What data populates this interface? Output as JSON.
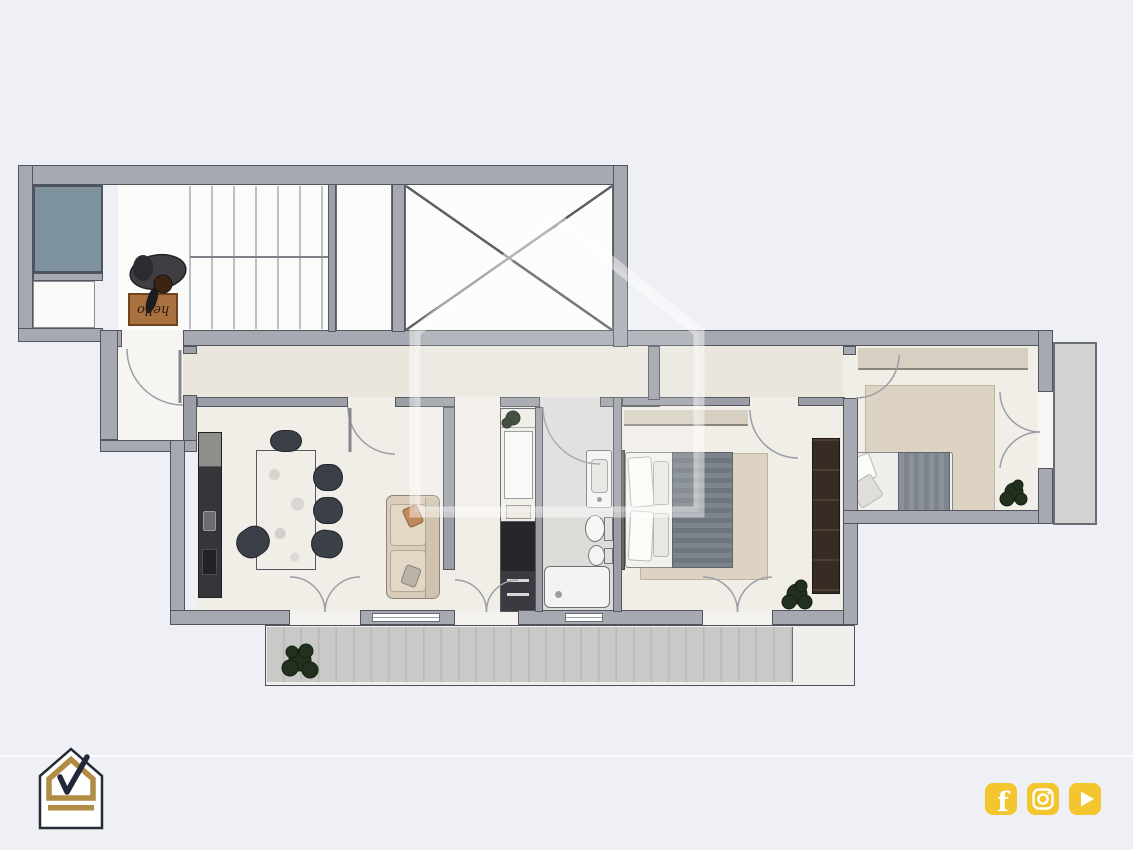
{
  "plan": {
    "doormat_text": "hello",
    "rooms": {
      "staircase": "Staircase",
      "elevator": "Elevator",
      "shaft": "Shaft",
      "entrance": "Entrance vestibule",
      "corridor": "Corridor",
      "living_kitchen": "Living room / Kitchen",
      "hallway": "Hallway",
      "closet_nook": "Closet nook",
      "bathroom": "Bathroom",
      "master_bedroom": "Bedroom 1",
      "bedroom2": "Bedroom 2",
      "terrace": "Terrace",
      "balcony": "Balcony"
    }
  },
  "colors": {
    "background": "#eef0f5",
    "wall": "#a6a9b1",
    "wall_outline": "#52555e",
    "room_floor": "#f1eee8",
    "corridor_floor": "#eae6de",
    "bathroom_floor": "#dcdcd9",
    "teal_square": "#7e929d",
    "terrace_deck": "#c9cac7",
    "rug": "#ddd3c2",
    "logo_gold": "#b08c45",
    "logo_dark": "#262b38",
    "social_yellow": "#F3C52F"
  },
  "footer": {
    "facebook_letter": "f",
    "social": [
      "facebook",
      "instagram",
      "youtube"
    ]
  }
}
